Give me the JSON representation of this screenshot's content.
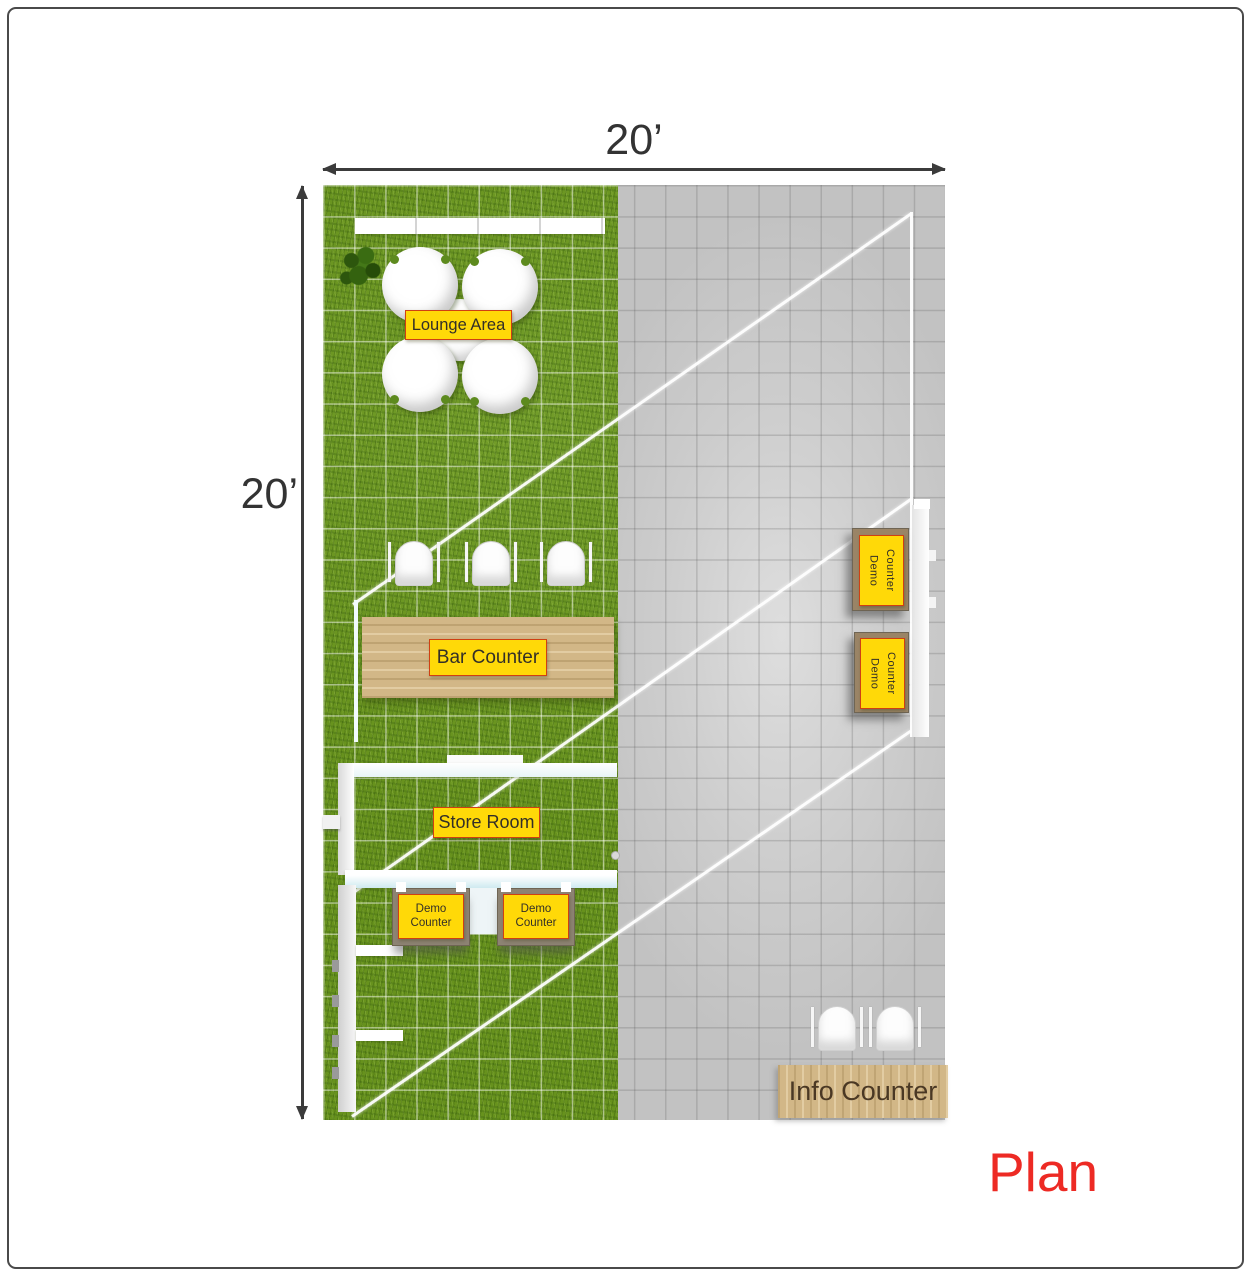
{
  "title": {
    "plan_label": "Plan"
  },
  "dimensions": {
    "width_label": "20’",
    "height_label": "20’"
  },
  "labels": {
    "lounge": "Lounge Area",
    "bar": "Bar Counter",
    "store": "Store Room",
    "demo_bottom_1": "Demo Counter",
    "demo_bottom_2": "Demo Counter",
    "demo_right_1": "Demo Counter",
    "demo_right_2": "Demo Counter",
    "info": "Info Counter"
  },
  "colors": {
    "label_background": "#ffd908",
    "label_border": "#cf4012",
    "plan_title_red": "#ed2a24",
    "grass_green": "#67921d",
    "floor_gray": "#c9c9c9",
    "wood": "#d2b787",
    "dimension_dark": "#3b3b3b"
  }
}
